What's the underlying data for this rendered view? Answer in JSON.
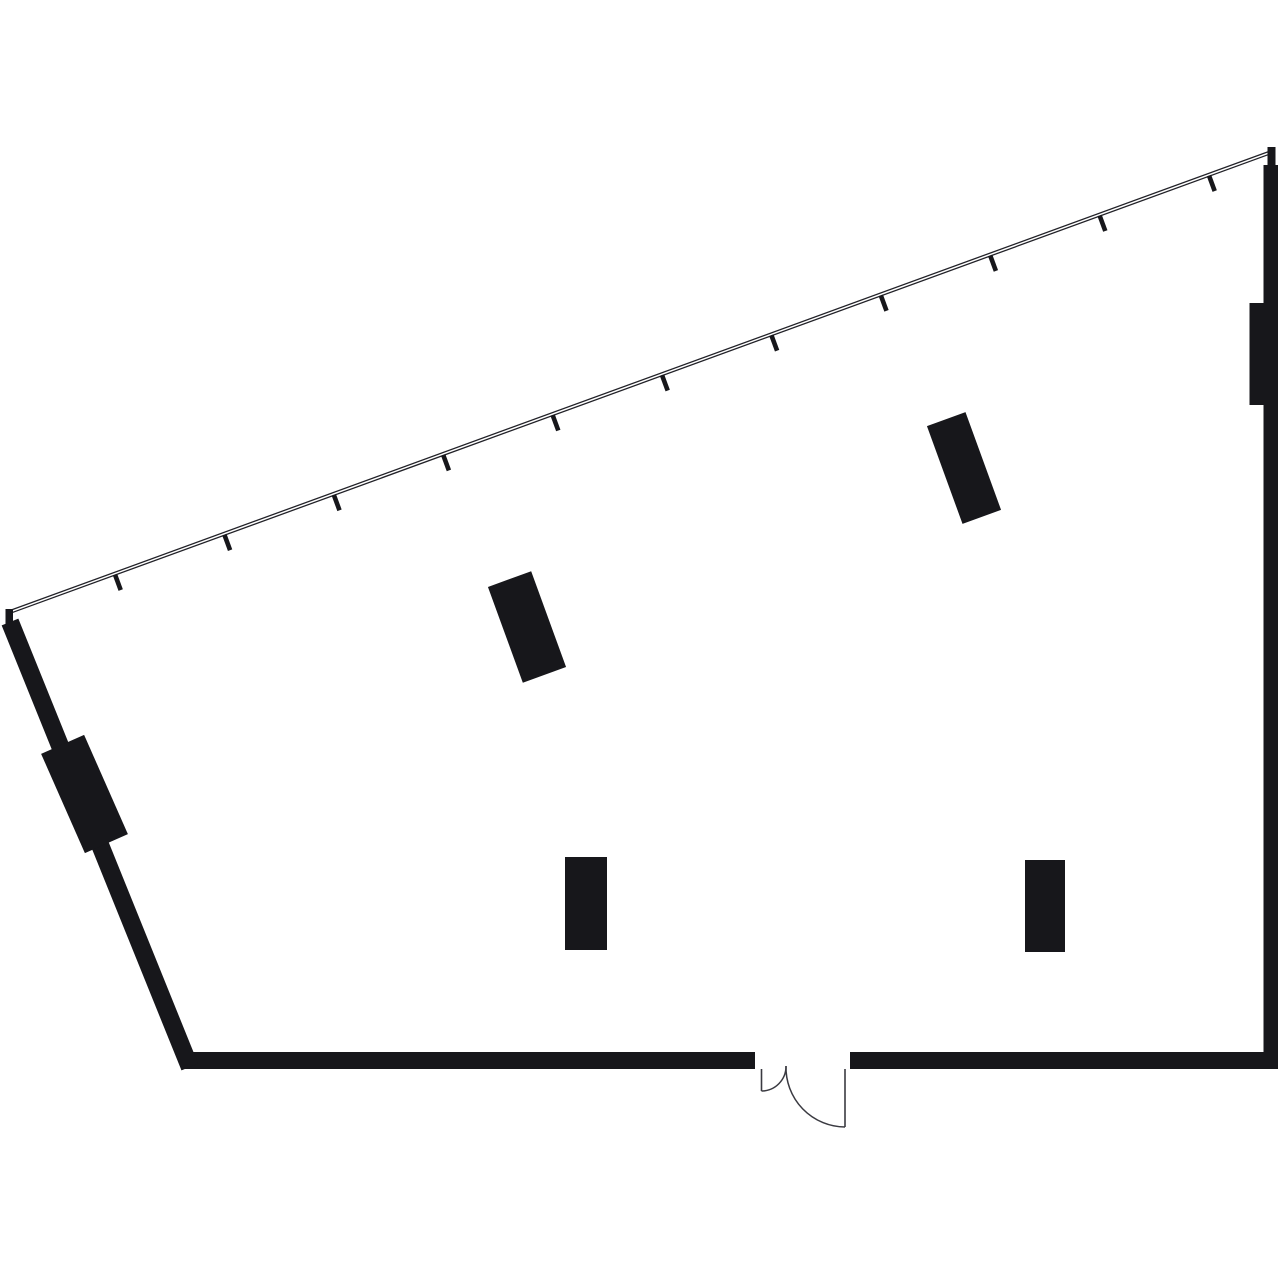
{
  "canvas": {
    "width": 1280,
    "height": 1278,
    "background": "#ffffff"
  },
  "palette": {
    "ink": "#17171b",
    "line": "#222228",
    "door": "#3a3a41",
    "background": "#ffffff"
  },
  "plan": {
    "shapes": [
      {
        "type": "line",
        "name": "window-wall-line-outer",
        "x1": 9.5,
        "y1": 610.6,
        "x2": 1268.5,
        "y2": 151.6,
        "stroke": "line",
        "width": 1.3
      },
      {
        "type": "line",
        "name": "window-wall-line-inner",
        "x1": 10.5,
        "y1": 613.2,
        "x2": 1269.5,
        "y2": 154.2,
        "stroke": "line",
        "width": 1.3
      },
      {
        "type": "line",
        "name": "mullion-tick",
        "x1": 115.0,
        "y1": 574.6,
        "x2": 120.7,
        "y2": 590.1,
        "stroke": "ink",
        "width": 4.6
      },
      {
        "type": "line",
        "name": "mullion-tick",
        "x1": 224.4,
        "y1": 534.7,
        "x2": 230.1,
        "y2": 550.2,
        "stroke": "ink",
        "width": 4.6
      },
      {
        "type": "line",
        "name": "mullion-tick",
        "x1": 333.8,
        "y1": 494.8,
        "x2": 339.5,
        "y2": 510.3,
        "stroke": "ink",
        "width": 4.6
      },
      {
        "type": "line",
        "name": "mullion-tick",
        "x1": 443.2,
        "y1": 454.9,
        "x2": 448.9,
        "y2": 470.4,
        "stroke": "ink",
        "width": 4.6
      },
      {
        "type": "line",
        "name": "mullion-tick",
        "x1": 552.6,
        "y1": 415.0,
        "x2": 558.3,
        "y2": 430.5,
        "stroke": "ink",
        "width": 4.6
      },
      {
        "type": "line",
        "name": "mullion-tick",
        "x1": 662.0,
        "y1": 375.1,
        "x2": 667.7,
        "y2": 390.6,
        "stroke": "ink",
        "width": 4.6
      },
      {
        "type": "line",
        "name": "mullion-tick",
        "x1": 771.4,
        "y1": 335.2,
        "x2": 777.1,
        "y2": 350.7,
        "stroke": "ink",
        "width": 4.6
      },
      {
        "type": "line",
        "name": "mullion-tick",
        "x1": 880.8,
        "y1": 295.3,
        "x2": 886.5,
        "y2": 310.8,
        "stroke": "ink",
        "width": 4.6
      },
      {
        "type": "line",
        "name": "mullion-tick",
        "x1": 990.2,
        "y1": 255.4,
        "x2": 995.9,
        "y2": 270.9,
        "stroke": "ink",
        "width": 4.6
      },
      {
        "type": "line",
        "name": "mullion-tick",
        "x1": 1099.6,
        "y1": 215.5,
        "x2": 1105.3,
        "y2": 231.0,
        "stroke": "ink",
        "width": 4.6
      },
      {
        "type": "line",
        "name": "mullion-tick",
        "x1": 1209.0,
        "y1": 175.6,
        "x2": 1214.7,
        "y2": 191.1,
        "stroke": "ink",
        "width": 4.6
      },
      {
        "type": "rect",
        "name": "window-wall-left-cap",
        "x": 5.5,
        "y": 609,
        "w": 7.5,
        "h": 15.5,
        "fill": "ink"
      },
      {
        "type": "rect",
        "name": "window-wall-right-cap",
        "x": 1267.5,
        "y": 147,
        "w": 8,
        "h": 20,
        "fill": "ink"
      },
      {
        "type": "rect",
        "name": "right-wall",
        "x": 1263.5,
        "y": 165,
        "w": 14.5,
        "h": 904,
        "fill": "ink"
      },
      {
        "type": "rect",
        "name": "right-wall-pilaster",
        "x": 1249.5,
        "y": 303,
        "w": 15,
        "h": 102,
        "fill": "ink"
      },
      {
        "type": "rect",
        "name": "bottom-wall-left",
        "x": 184,
        "y": 1052,
        "w": 571,
        "h": 17,
        "fill": "ink"
      },
      {
        "type": "rect",
        "name": "bottom-wall-right",
        "x": 850,
        "y": 1052,
        "w": 414,
        "h": 17,
        "fill": "ink"
      },
      {
        "type": "rect",
        "name": "left-wall",
        "x": 1,
        "y": 622,
        "w": 18,
        "h": 480,
        "fill": "ink",
        "rotate": [
          -22,
          10,
          622
        ]
      },
      {
        "type": "rect",
        "name": "left-wall-pilaster",
        "x": 61,
        "y": 739.75,
        "w": 47,
        "h": 108.5,
        "fill": "ink",
        "rotate": [
          -23.8,
          84.5,
          794
        ]
      },
      {
        "type": "rect",
        "name": "interior-block-upper-left",
        "x": 504,
        "y": 576,
        "w": 46,
        "h": 102,
        "fill": "ink",
        "rotate": [
          -20,
          527,
          627
        ]
      },
      {
        "type": "rect",
        "name": "interior-block-upper-right",
        "x": 943.5,
        "y": 416,
        "w": 41,
        "h": 104,
        "fill": "ink",
        "rotate": [
          -20,
          964,
          468
        ]
      },
      {
        "type": "rect",
        "name": "interior-block-lower-left",
        "x": 565,
        "y": 857,
        "w": 42,
        "h": 93,
        "fill": "ink"
      },
      {
        "type": "rect",
        "name": "interior-block-lower-right",
        "x": 1025,
        "y": 860,
        "w": 40,
        "h": 92,
        "fill": "ink"
      },
      {
        "type": "line",
        "name": "door-left-jamb-leaf",
        "x1": 761.5,
        "y1": 1069,
        "x2": 761.5,
        "y2": 1091,
        "stroke": "door",
        "width": 1.6
      },
      {
        "type": "path",
        "name": "door-left-swing-arc",
        "d": "M 761.5 1091 A 24.7 24.7 0 0 0 786 1066",
        "stroke": "door",
        "width": 1.5
      },
      {
        "type": "path",
        "name": "door-right-swing-arc",
        "d": "M 786 1066 A 59.5 59.5 0 0 0 845 1127",
        "stroke": "door",
        "width": 1.5
      },
      {
        "type": "line",
        "name": "door-right-leaf",
        "x1": 845,
        "y1": 1127,
        "x2": 845,
        "y2": 1069,
        "stroke": "door",
        "width": 1.6
      }
    ]
  }
}
